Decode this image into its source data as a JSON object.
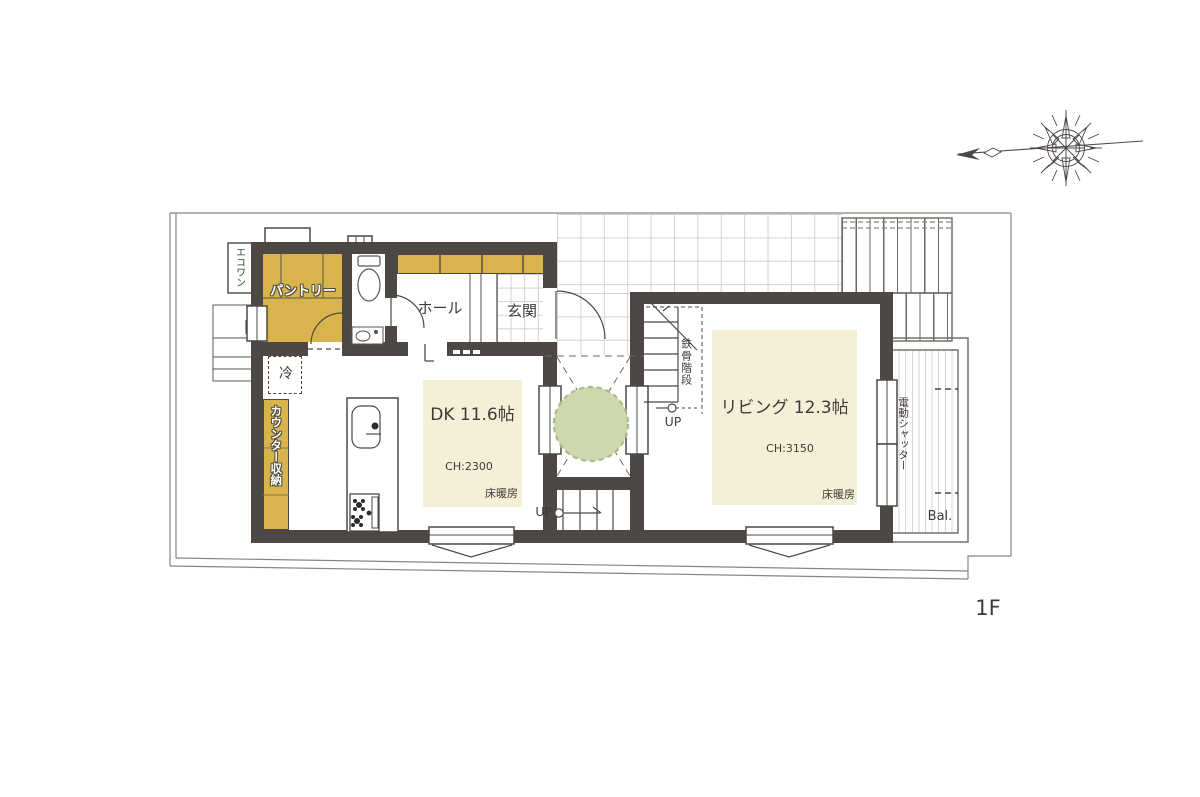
{
  "plan": {
    "floor_label": "1F",
    "rooms": {
      "pantry": {
        "label": "パントリー"
      },
      "hall": {
        "label": "ホール"
      },
      "entrance": {
        "label": "玄関"
      },
      "dining_kitchen": {
        "label": "DK 11.6帖",
        "ceiling_height": "CH:2300",
        "floor_heating": "床暖房"
      },
      "living": {
        "label": "リビング 12.3帖",
        "ceiling_height": "CH:3150",
        "floor_heating": "床暖房"
      },
      "balcony": {
        "label": "Bal."
      }
    },
    "features": {
      "steel_stairs": "鉄骨階段",
      "stairs_up": "UP",
      "entry_steps_up": "UP",
      "refrigerator": "冷",
      "counter_storage": "カウンター収納",
      "eco_one": "エコワン",
      "electric_shutter": "電動シャッター"
    },
    "colors": {
      "wall": "#4d4846",
      "storage_gold": "#d9b44c",
      "floor_heating_cream": "#f6efd8",
      "tree_green": "#cdd8ad",
      "boundary_gray": "#8a8580"
    }
  }
}
